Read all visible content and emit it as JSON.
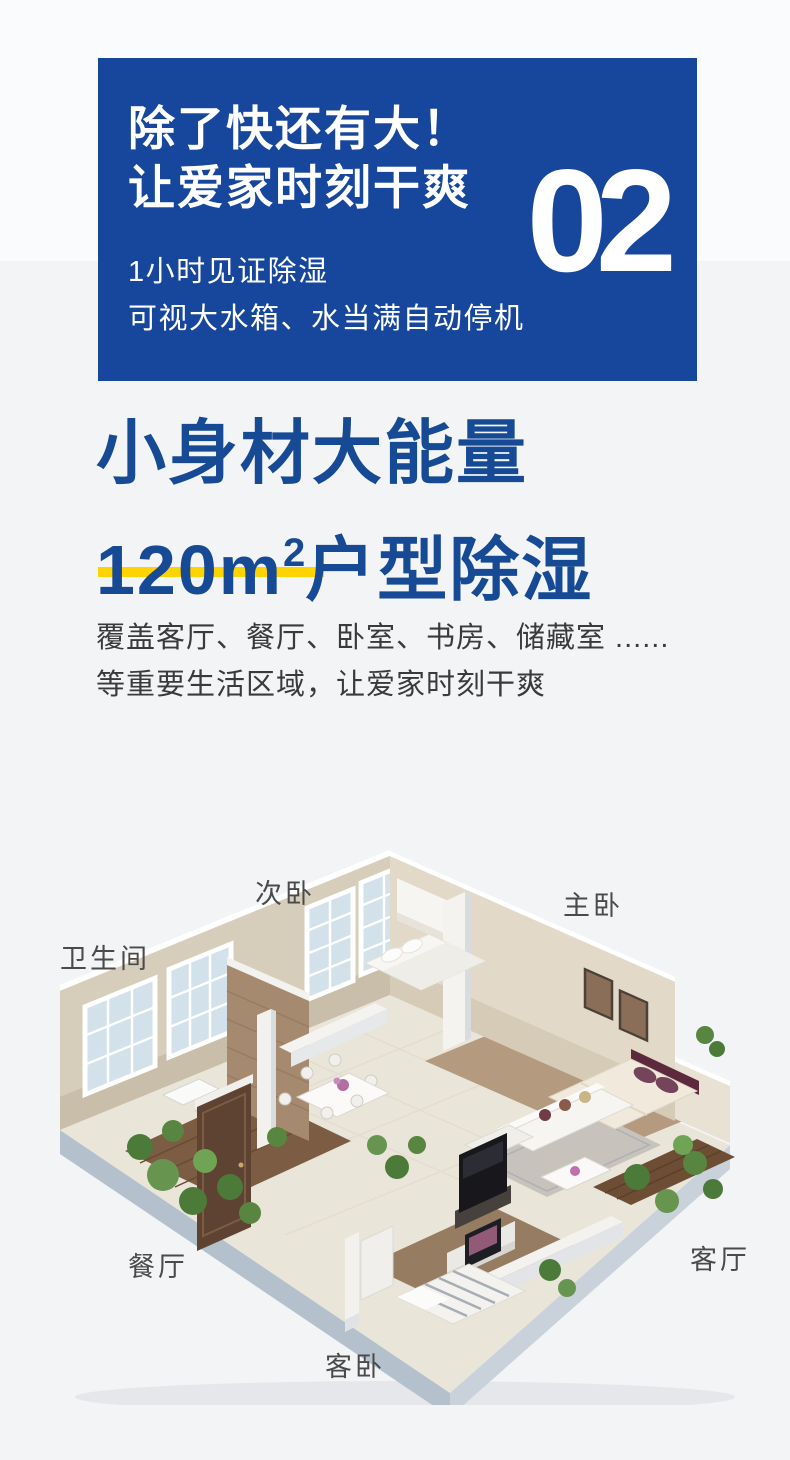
{
  "colors": {
    "hero_bg": "#17479c",
    "headline_blue": "#164a94",
    "underline_yellow": "#ffd300",
    "bg_top": "#fafbfc",
    "bg_main": "#f3f4f6"
  },
  "hero": {
    "title_line1": "除了快还有大！",
    "title_line2": "让爱家时刻干爽",
    "section_number": "02",
    "subtitle_line1": "1小时见证除湿",
    "subtitle_line2": "可视大水箱、水当满自动停机"
  },
  "main": {
    "headline_line1": "小身材大能量",
    "headline_line2_prefix": "120m",
    "headline_line2_sup": "2",
    "headline_line2_suffix": "户型除湿",
    "desc_line1": "覆盖客厅、餐厅、卧室、书房、储藏室 ......",
    "desc_line2": "等重要生活区域，让爱家时刻干爽"
  },
  "floorplan": {
    "labels": [
      {
        "id": "secondary-bedroom",
        "text": "次卧"
      },
      {
        "id": "master-bedroom",
        "text": "主卧"
      },
      {
        "id": "bathroom",
        "text": "卫生间"
      },
      {
        "id": "dining-room",
        "text": "餐厅"
      },
      {
        "id": "living-room",
        "text": "客厅"
      },
      {
        "id": "guest-bedroom",
        "text": "客卧"
      }
    ]
  }
}
